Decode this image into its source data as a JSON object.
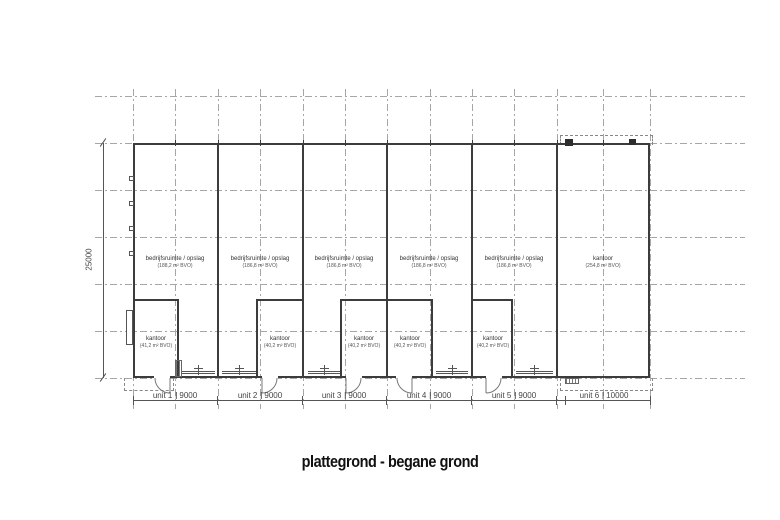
{
  "title": "plattegrond - begane grond",
  "left_dimension": "25000",
  "units": [
    {
      "label": "unit 1",
      "size": "9000",
      "room": {
        "name": "bedrijfsruimte / opslag",
        "area": "(188,2 m² BVO)"
      },
      "kantoor": {
        "name": "kantoor",
        "area": "(41,2 m² BVO)"
      }
    },
    {
      "label": "unit 2",
      "size": "9000",
      "room": {
        "name": "bedrijfsruimte / opslag",
        "area": "(186,8 m² BVO)"
      },
      "kantoor": {
        "name": "kantoor",
        "area": "(40,2 m² BVO)"
      }
    },
    {
      "label": "unit 3",
      "size": "9000",
      "room": {
        "name": "bedrijfsruimte / opslag",
        "area": "(186,8 m² BVO)"
      },
      "kantoor": {
        "name": "kantoor",
        "area": "(40,2 m² BVO)"
      }
    },
    {
      "label": "unit 4",
      "size": "9000",
      "room": {
        "name": "bedrijfsruimte / opslag",
        "area": "(186,8 m² BVO)"
      },
      "kantoor": {
        "name": "kantoor",
        "area": "(40,2 m² BVO)"
      }
    },
    {
      "label": "unit 5",
      "size": "9000",
      "room": {
        "name": "bedrijfsruimte / opslag",
        "area": "(186,8 m² BVO)"
      },
      "kantoor": {
        "name": "kantoor",
        "area": "(40,2 m² BVO)"
      }
    },
    {
      "label": "unit 6",
      "size": "10000",
      "room": {
        "name": "kantoor",
        "area": "(254,8 m² BVO)"
      }
    }
  ]
}
